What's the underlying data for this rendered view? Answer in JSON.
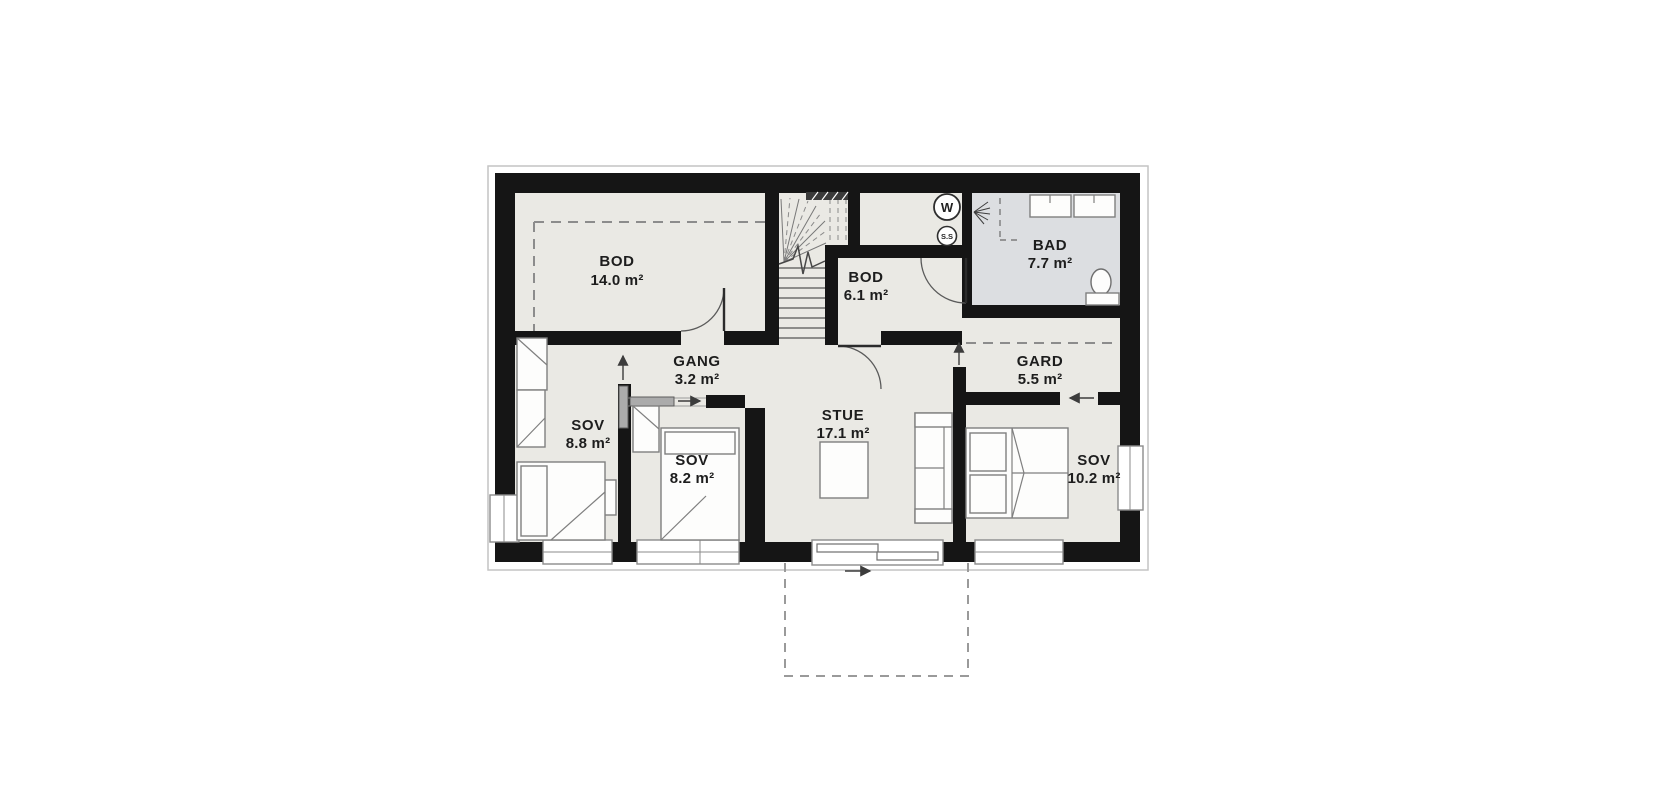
{
  "plan": {
    "colors": {
      "wall": "#151515",
      "floor": "#eae9e4",
      "bathroom_floor": "#dcdee1",
      "outline_gray": "#c4c4c4"
    },
    "rooms": [
      {
        "name": "BOD",
        "area": "14.0 m²"
      },
      {
        "name": "BOD",
        "area": "6.1 m²"
      },
      {
        "name": "BAD",
        "area": "7.7 m²"
      },
      {
        "name": "GANG",
        "area": "3.2 m²"
      },
      {
        "name": "GARD",
        "area": "5.5 m²"
      },
      {
        "name": "SOV",
        "area": "8.8 m²"
      },
      {
        "name": "SOV",
        "area": "8.2 m²"
      },
      {
        "name": "STUE",
        "area": "17.1 m²"
      },
      {
        "name": "SOV",
        "area": "10.2 m²"
      }
    ],
    "symbols": {
      "water_heater": "W",
      "ss": "S.S"
    }
  }
}
